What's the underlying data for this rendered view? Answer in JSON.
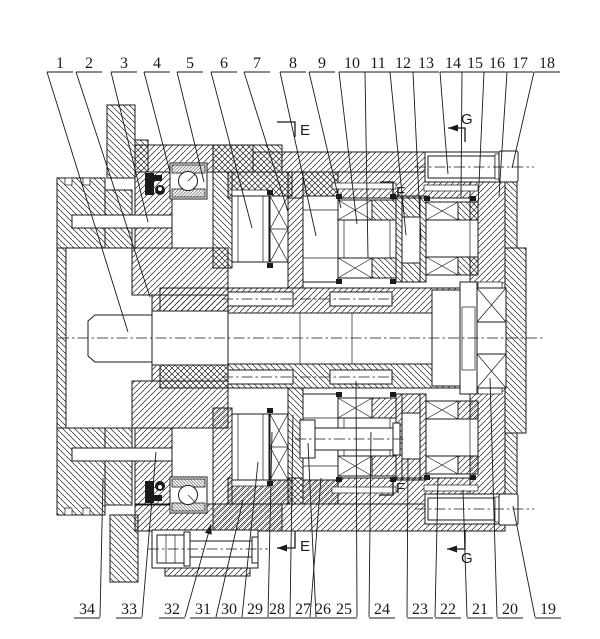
{
  "page": {
    "background": "#ffffff",
    "ink": "#1a1a1a"
  },
  "figure": {
    "kind": "sectional assembly drawing"
  },
  "callouts": {
    "top_row_text_y": 68,
    "top_row_underline_y": 72,
    "bottom_row_text_y": 614,
    "bottom_row_underline_y": 618,
    "top": [
      {
        "label": "1",
        "lx": 60,
        "tx": 128,
        "ty": 332
      },
      {
        "label": "2",
        "lx": 89,
        "tx": 150,
        "ty": 297
      },
      {
        "label": "3",
        "lx": 124,
        "tx": 148,
        "ty": 222
      },
      {
        "label": "4",
        "lx": 157,
        "tx": 170,
        "ty": 172
      },
      {
        "label": "5",
        "lx": 190,
        "tx": 204,
        "ty": 182
      },
      {
        "label": "6",
        "lx": 224,
        "tx": 252,
        "ty": 228
      },
      {
        "label": "7",
        "lx": 257,
        "tx": 288,
        "ty": 212
      },
      {
        "label": "8",
        "lx": 293,
        "tx": 316,
        "ty": 236
      },
      {
        "label": "9",
        "lx": 322,
        "tx": 341,
        "ty": 208
      },
      {
        "label": "10",
        "lx": 352,
        "tx": 357,
        "ty": 224
      },
      {
        "label": "11",
        "lx": 378,
        "tx": 368,
        "ty": 258
      },
      {
        "label": "12",
        "lx": 403,
        "tx": 406,
        "ty": 235
      },
      {
        "label": "13",
        "lx": 426,
        "tx": 421,
        "ty": 240
      },
      {
        "label": "14",
        "lx": 453,
        "tx": 448,
        "ty": 174
      },
      {
        "label": "15",
        "lx": 475,
        "tx": 461,
        "ty": 198
      },
      {
        "label": "16",
        "lx": 497,
        "tx": 478,
        "ty": 206
      },
      {
        "label": "17",
        "lx": 520,
        "tx": 499,
        "ty": 196
      },
      {
        "label": "18",
        "lx": 547,
        "tx": 512,
        "ty": 168
      }
    ],
    "bottom": [
      {
        "label": "34",
        "lx": 87,
        "tx": 103,
        "ty": 478
      },
      {
        "label": "33",
        "lx": 129,
        "tx": 156,
        "ty": 452
      },
      {
        "label": "32",
        "lx": 172,
        "tx": 211,
        "ty": 524,
        "arrow": true
      },
      {
        "label": "31",
        "lx": 203,
        "tx": 243,
        "ty": 500
      },
      {
        "label": "30",
        "lx": 229,
        "tx": 258,
        "ty": 462
      },
      {
        "label": "29",
        "lx": 255,
        "tx": 272,
        "ty": 432
      },
      {
        "label": "28",
        "lx": 277,
        "tx": 293,
        "ty": 415
      },
      {
        "label": "27",
        "lx": 303,
        "tx": 308,
        "ty": 443
      },
      {
        "label": "26",
        "lx": 323,
        "tx": 321,
        "ty": 478
      },
      {
        "label": "25",
        "lx": 344,
        "tx": 356,
        "ty": 381
      },
      {
        "label": "24",
        "lx": 382,
        "tx": 371,
        "ty": 432
      },
      {
        "label": "23",
        "lx": 420,
        "tx": 408,
        "ty": 458
      },
      {
        "label": "22",
        "lx": 448,
        "tx": 438,
        "ty": 478
      },
      {
        "label": "21",
        "lx": 480,
        "tx": 463,
        "ty": 490
      },
      {
        "label": "20",
        "lx": 510,
        "tx": 490,
        "ty": 378
      },
      {
        "label": "19",
        "lx": 548,
        "tx": 513,
        "ty": 506
      }
    ]
  },
  "section_markers": [
    {
      "letter": "E",
      "ltx": 300,
      "lty": 135,
      "pts": [
        [
          277,
          122
        ],
        [
          295,
          122
        ],
        [
          295,
          137
        ]
      ],
      "arrow": null
    },
    {
      "letter": "E",
      "ltx": 300,
      "lty": 551,
      "pts": [
        [
          295,
          531
        ],
        [
          295,
          548
        ],
        [
          277,
          548
        ]
      ],
      "arrow": [
        277,
        548
      ]
    },
    {
      "letter": "F",
      "ltx": 396,
      "lty": 197,
      "pts": [
        [
          380,
          182
        ],
        [
          393,
          182
        ],
        [
          393,
          200
        ]
      ],
      "arrow": null
    },
    {
      "letter": "F",
      "ltx": 396,
      "lty": 493,
      "pts": [
        [
          393,
          480
        ],
        [
          393,
          495
        ],
        [
          379,
          495
        ]
      ],
      "arrow": null
    },
    {
      "letter": "G",
      "ltx": 461,
      "lty": 124,
      "pts": [
        [
          448,
          128
        ],
        [
          465,
          128
        ],
        [
          465,
          142
        ]
      ],
      "arrow": [
        448,
        128
      ]
    },
    {
      "letter": "G",
      "ltx": 461,
      "lty": 563,
      "pts": [
        [
          465,
          530
        ],
        [
          465,
          549
        ],
        [
          447,
          549
        ]
      ],
      "arrow": [
        447,
        549
      ]
    }
  ]
}
